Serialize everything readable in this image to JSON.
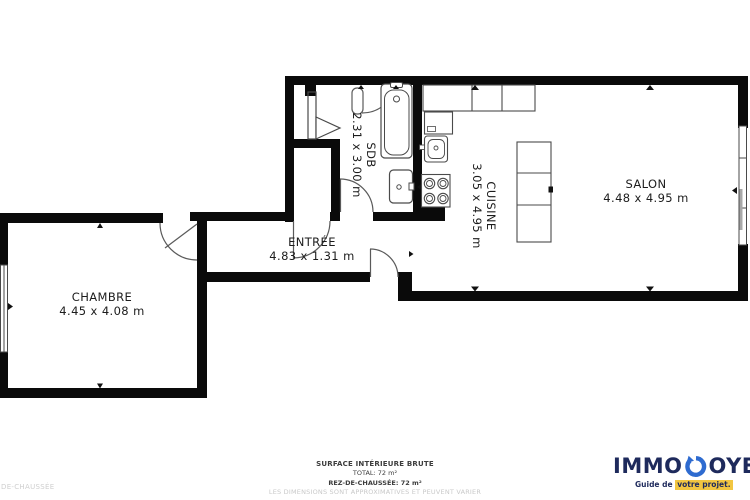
{
  "plan": {
    "type": "floor-plan",
    "rooms": {
      "chambre": {
        "label": "CHAMBRE",
        "dims": "4.45 x 4.08 m"
      },
      "entree": {
        "label": "ENTRÉE",
        "dims": "4.83 x 1.31 m"
      },
      "sdb": {
        "label": "SDB",
        "dims": "2.31 x 3.00 m"
      },
      "cuisine": {
        "label": "CUISINE",
        "dims": "3.05 x 4.95 m"
      },
      "salon": {
        "label": "SALON",
        "dims": "4.48 x 4.95 m"
      }
    },
    "fixtures": [
      "bathtub",
      "washbasin",
      "folding-door",
      "sliding-door",
      "kitchen-counter",
      "refrigerator",
      "kitchen-sink",
      "stove",
      "kitchen-island",
      "window",
      "door-arc"
    ],
    "colors": {
      "wall": "#0a0a0a",
      "line": "#4a4a4a",
      "text": "#1c1c1c"
    }
  },
  "footer": {
    "surface_title": "SURFACE INTÉRIEURE BRUTE",
    "total": "TOTAL: 72 m²",
    "floor": "REZ-DE-CHAUSSÉE: 72 m²",
    "disclaimer": "LES DIMENSIONS SONT APPROXIMATIVES ET PEUVENT VARIER",
    "left_text": "DE-CHAUSSÉE"
  },
  "logo": {
    "brand_prefix": "IMMO",
    "brand_suffix": "OYE",
    "tagline_prefix": "Guide de ",
    "tagline_highlight": "votre projet.",
    "colors": {
      "navy": "#1e2a5c",
      "blue": "#2e6bd0",
      "yellow": "#f2c641"
    }
  }
}
